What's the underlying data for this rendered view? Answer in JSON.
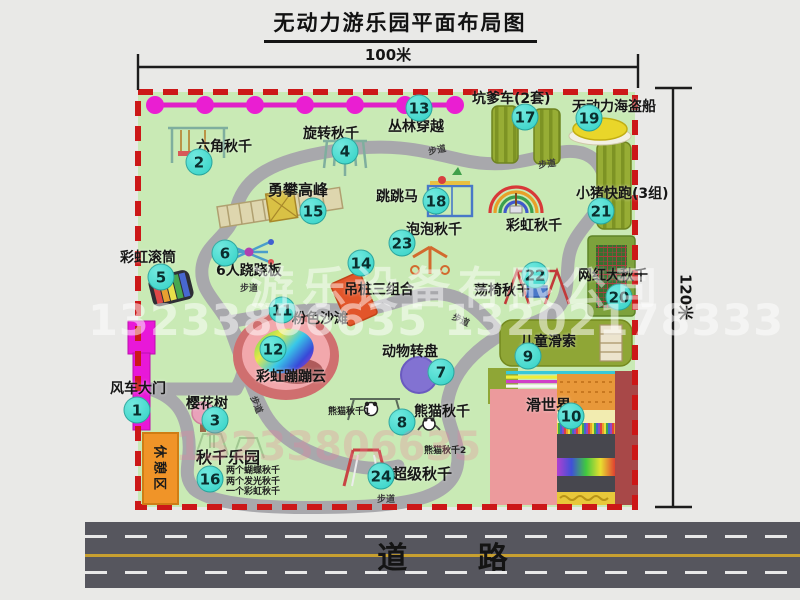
{
  "title": "无动力游乐园平面布局图",
  "dimensions": {
    "width_label": "100米",
    "height_label": "120米"
  },
  "road": {
    "label": "道 路"
  },
  "trail_label": "步道",
  "rest_area": {
    "label": "休憩区"
  },
  "watermark": {
    "company": "游乐设备有限公司",
    "phones": "13233806635 13202178333",
    "phones_faint": "13233806635"
  },
  "pois": [
    {
      "num": "1",
      "name": "风车大门"
    },
    {
      "num": "2",
      "name": "六角秋千"
    },
    {
      "num": "3",
      "name": "樱花树"
    },
    {
      "num": "4",
      "name": "旋转秋千"
    },
    {
      "num": "5",
      "name": "彩虹滚筒"
    },
    {
      "num": "6",
      "name": "6人跷跷板"
    },
    {
      "num": "7",
      "name": "动物转盘"
    },
    {
      "num": "8",
      "name": "熊猫秋千"
    },
    {
      "num": "9",
      "name": "儿童滑索"
    },
    {
      "num": "10",
      "name": "滑世界"
    },
    {
      "num": "11",
      "name": "粉色沙滩"
    },
    {
      "num": "12",
      "name": "彩虹蹦蹦云"
    },
    {
      "num": "13",
      "name": "丛林穿越"
    },
    {
      "num": "14",
      "name": "吊桩三组合"
    },
    {
      "num": "15",
      "name": "勇攀高峰"
    },
    {
      "num": "16",
      "name": "秋千乐园"
    },
    {
      "num": "17",
      "name": "坑爹车(2套)"
    },
    {
      "num": "18",
      "name": "跳跳马"
    },
    {
      "num": "19",
      "name": "无动力海盗船"
    },
    {
      "num": "20",
      "name": "网红大秋千"
    },
    {
      "num": "21",
      "name": "小猪快跑(3组)"
    },
    {
      "num": "22",
      "name": "荡椅秋千"
    },
    {
      "num": "23",
      "name": "泡泡秋千"
    },
    {
      "num": "24",
      "name": "超级秋千"
    }
  ],
  "unnumbered_labels": {
    "rainbow_swing": "彩虹秋千"
  },
  "sub_labels": {
    "panda_swing_1": "熊猫秋千1",
    "panda_swing_2": "熊猫秋千2"
  },
  "swing_park_details": [
    "两个蝴蝶秋千",
    "两个发光秋千",
    "一个彩虹秋千"
  ],
  "colors": {
    "badge": "#3ED8CC",
    "map_green": "#C9EAB5",
    "border_red": "#CC1818",
    "gate_magenta": "#E818D8",
    "equipment_olive": "#94AA34",
    "rest_area_orange": "#F09428",
    "road_gray": "#56565E"
  }
}
